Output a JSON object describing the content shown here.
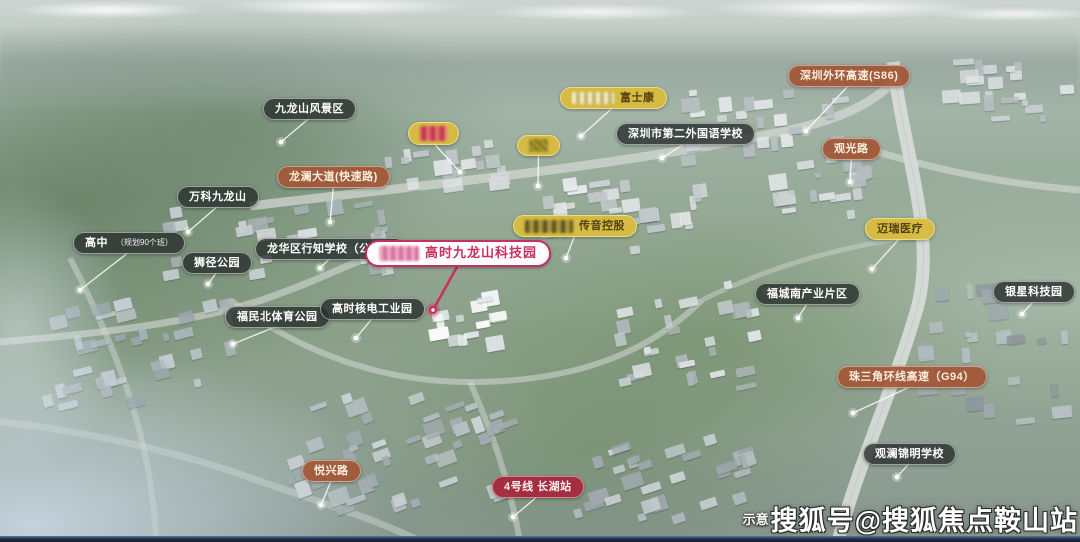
{
  "project": {
    "name": "高时九龙山科技园"
  },
  "colors": {
    "label_dark": "#2a312e",
    "label_brown": "#a2573a",
    "label_yellow": "#d7bb40",
    "label_crimson": "#a62a3d",
    "primary_pink": "#c9305f",
    "leader_white": "#ffffff",
    "bottom_bar": "#1a2636"
  },
  "footer": {
    "note": "示意",
    "watermark": "搜狐号@搜狐焦点鞍山站"
  },
  "map_labels": [
    {
      "id": "jiulongshan-scenic-area",
      "text": "九龙山风景区",
      "style": "dark",
      "x": 263,
      "y": 98,
      "dot": [
        281,
        142
      ]
    },
    {
      "id": "longlan-avenue",
      "text": "龙澜大道(快速路)",
      "style": "brown",
      "x": 277,
      "y": 166,
      "dot": [
        330,
        222
      ]
    },
    {
      "id": "company-blurred-1",
      "text": "",
      "style": "yellow",
      "x": 408,
      "y": 122,
      "dot": [
        460,
        172
      ],
      "logo": "red"
    },
    {
      "id": "company-blurred-2",
      "text": "",
      "style": "yellow",
      "x": 517,
      "y": 135,
      "dot": [
        538,
        186
      ],
      "logo": "olive"
    },
    {
      "id": "foxconn",
      "text": "富士康",
      "style": "yellow",
      "x": 560,
      "y": 87,
      "dot": [
        581,
        136
      ],
      "logo": "gray"
    },
    {
      "id": "sz-second-foreign-school",
      "text": "深圳市第二外国语学校",
      "style": "dark",
      "x": 616,
      "y": 123,
      "dot": [
        662,
        158
      ]
    },
    {
      "id": "sz-outer-ring-expressway",
      "text": "深圳外环高速(S86)",
      "style": "brown",
      "x": 788,
      "y": 65,
      "dot": [
        806,
        131
      ]
    },
    {
      "id": "guanguang-road",
      "text": "观光路",
      "style": "brown",
      "x": 822,
      "y": 138,
      "dot": [
        850,
        182
      ]
    },
    {
      "id": "vanke-jiulongshan",
      "text": "万科九龙山",
      "style": "dark",
      "x": 177,
      "y": 186,
      "dot": [
        188,
        232
      ]
    },
    {
      "id": "high-school-planned",
      "text": "高中",
      "sub": "（规划90个班）",
      "style": "dark",
      "x": 73,
      "y": 232,
      "dot": [
        80,
        290
      ]
    },
    {
      "id": "shijing-park",
      "text": "狮径公园",
      "style": "dark",
      "x": 182,
      "y": 252,
      "dot": [
        208,
        284
      ]
    },
    {
      "id": "longhua-xingzhi-school",
      "text": "龙华区行知学校（公立）",
      "style": "dark",
      "x": 255,
      "y": 238,
      "dot": [
        320,
        268
      ]
    },
    {
      "id": "gaoshi-jiulongshan-tech-park",
      "text": "高时九龙山科技园",
      "style": "primary",
      "x": 365,
      "y": 240,
      "dot": [
        433,
        310
      ],
      "logo": "pink"
    },
    {
      "id": "transsion-holdings",
      "text": "传音控股",
      "style": "yellow",
      "x": 513,
      "y": 215,
      "dot": [
        566,
        258
      ],
      "logo": "dark"
    },
    {
      "id": "mindray-medical",
      "text": "迈瑞医疗",
      "style": "yellow",
      "x": 865,
      "y": 218,
      "dot": [
        872,
        269
      ]
    },
    {
      "id": "fucheng-south-industry-zone",
      "text": "福城南产业片区",
      "style": "dark",
      "x": 755,
      "y": 283,
      "dot": [
        798,
        318
      ]
    },
    {
      "id": "yinxing-tech-park",
      "text": "银星科技园",
      "style": "dark",
      "x": 993,
      "y": 281,
      "dot": [
        1022,
        314
      ]
    },
    {
      "id": "prd-ring-expressway",
      "text": "珠三角环线高速（G94）",
      "style": "brown",
      "x": 837,
      "y": 366,
      "dot": [
        853,
        413
      ]
    },
    {
      "id": "guanlan-jinming-school",
      "text": "观澜锦明学校",
      "style": "dark",
      "x": 863,
      "y": 443,
      "dot": [
        897,
        477
      ]
    },
    {
      "id": "fumin-north-sports-park",
      "text": "福民北体育公园",
      "style": "dark",
      "x": 225,
      "y": 306,
      "dot": [
        233,
        344
      ]
    },
    {
      "id": "gaoshi-nuclear-industrial-park",
      "text": "高时核电工业园",
      "style": "dark",
      "x": 320,
      "y": 298,
      "dot": [
        356,
        338
      ]
    },
    {
      "id": "yuexing-road",
      "text": "悦兴路",
      "style": "brown",
      "x": 302,
      "y": 460,
      "dot": [
        321,
        505
      ]
    },
    {
      "id": "line4-changhu-station",
      "text": "4号线 长湖站",
      "style": "crimson",
      "x": 492,
      "y": 476,
      "dot": [
        513,
        517
      ]
    }
  ]
}
